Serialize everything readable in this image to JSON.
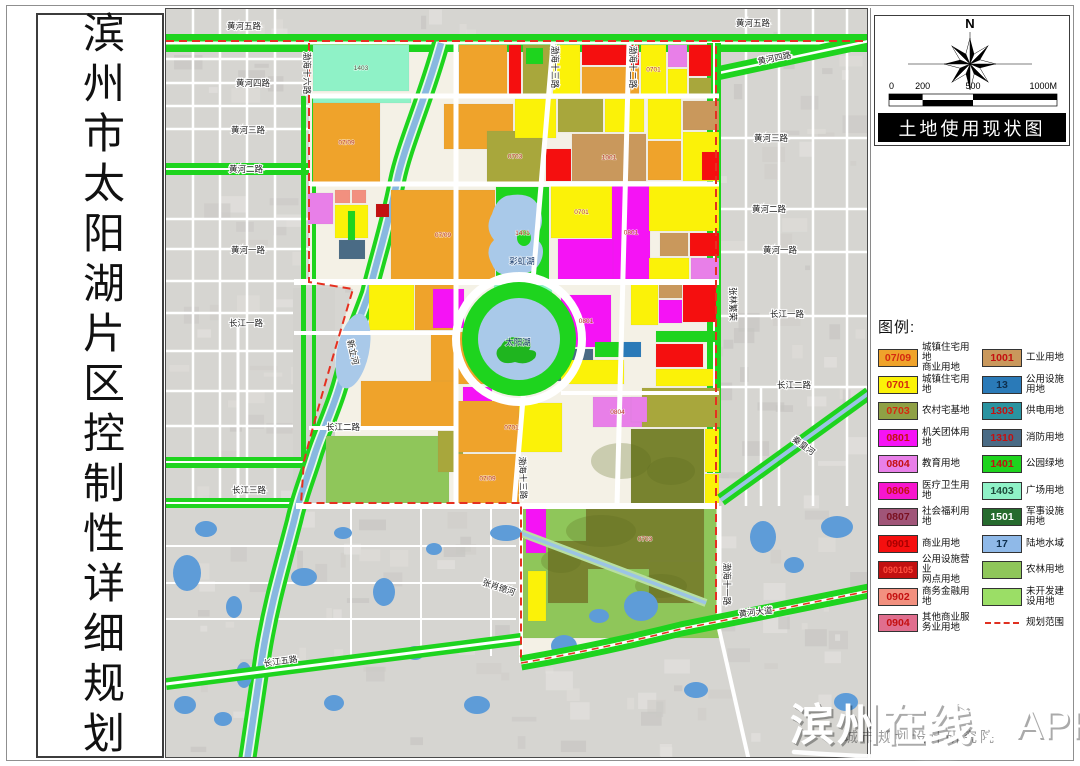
{
  "page_title": "滨州市太阳湖片区控制性详细规划",
  "map_title": "土地使用现状图",
  "compass": {
    "north_label": "N"
  },
  "scale": {
    "ticks": [
      "0",
      "200",
      "500",
      "1000M"
    ]
  },
  "legend": {
    "heading": "图例:",
    "left": [
      {
        "code": "07/09",
        "color": "#EFA32B",
        "code_color": "#D42A10",
        "label": "城镇住宅用地\n商业用地"
      },
      {
        "code": "0701",
        "color": "#FBF208",
        "code_color": "#D42A10",
        "label": "城镇住宅用地"
      },
      {
        "code": "0703",
        "color": "#8FA045",
        "code_color": "#D42A10",
        "label": "农村宅基地"
      },
      {
        "code": "0801",
        "color": "#F513F5",
        "code_color": "#C41010",
        "label": "机关团体用地"
      },
      {
        "code": "0804",
        "color": "#E87FE8",
        "code_color": "#C41010",
        "label": "教育用地"
      },
      {
        "code": "0806",
        "color": "#F716CE",
        "code_color": "#C41010",
        "label": "医疗卫生用地"
      },
      {
        "code": "0807",
        "color": "#A05578",
        "code_color": "#7A1020",
        "label": "社会福利用地"
      },
      {
        "code": "0901",
        "color": "#F50F0F",
        "code_color": "#A80000",
        "label": "商业用地"
      },
      {
        "code": "090105",
        "color": "#C21010",
        "code_color": "#FF5040",
        "label": "公用设施营业\n网点用地"
      },
      {
        "code": "0902",
        "color": "#F2907F",
        "code_color": "#C41010",
        "label": "商务金融用地"
      },
      {
        "code": "0904",
        "color": "#E06E8E",
        "code_color": "#C41010",
        "label": "其他商业服\n务业用地"
      }
    ],
    "right": [
      {
        "code": "1001",
        "color": "#C9985C",
        "code_color": "#C41010",
        "label": "工业用地"
      },
      {
        "code": "13",
        "color": "#2A7AB8",
        "code_color": "#0E2F4E",
        "label": "公用设施用地"
      },
      {
        "code": "1303",
        "color": "#2A93A0",
        "code_color": "#C41010",
        "label": "供电用地"
      },
      {
        "code": "1310",
        "color": "#4A6B85",
        "code_color": "#C41010",
        "label": "消防用地"
      },
      {
        "code": "1401",
        "color": "#1ED41E",
        "code_color": "#C41010",
        "label": "公园绿地"
      },
      {
        "code": "1403",
        "color": "#8FF2C7",
        "code_color": "#1E4A3A",
        "label": "广场用地"
      },
      {
        "code": "1501",
        "color": "#266B2E",
        "code_color": "#FFFFFF",
        "label": "军事设施用地"
      },
      {
        "code": "17",
        "color": "#8FB9E8",
        "code_color": "#0E2F4E",
        "label": "陆地水域"
      },
      {
        "code": "",
        "color": "#8FC65A",
        "code_color": "#000",
        "label": "农林用地"
      },
      {
        "code": "",
        "color": "#9BDE66",
        "code_color": "#000",
        "label": "未开发建设用地"
      },
      {
        "code": "",
        "color": "dash",
        "code_color": "#000",
        "label": "规划范围"
      }
    ]
  },
  "watermark": {
    "main": "滨州在线",
    "suffix": "APP",
    "behind": "城市规划设计研究院"
  },
  "map": {
    "palette": {
      "or": "#EFA32B",
      "ye": "#FBF208",
      "ol": "#A8A73C",
      "mg": "#F513F5",
      "vi": "#E87FE8",
      "pk": "#F716CE",
      "mv": "#A05578",
      "rd": "#F50F0F",
      "dr": "#C21010",
      "sa": "#F2907F",
      "ro": "#E06E8E",
      "tn": "#C9985C",
      "bl": "#2A7AB8",
      "te": "#2A93A0",
      "sl": "#4A6B85",
      "gr": "#1ED41E",
      "mi": "#8FF2C7",
      "dg": "#266B2E",
      "wa": "#8FB9E8",
      "fa": "#8FC65A",
      "un": "#9BDE66",
      "do": "#78832F",
      "gy": "#D3D2CE",
      "lk": "#A9C9E9",
      "pd": "#5E9CD8",
      "road": "#FFFFFF",
      "base": "#D6D5D1",
      "inner": "#F4F1E6",
      "boundary": "#E53020"
    },
    "parcels": [
      [
        312,
        44,
        96,
        46,
        "mi",
        "1403"
      ],
      [
        312,
        93,
        98,
        9,
        "mi"
      ],
      [
        458,
        44,
        48,
        49,
        "or"
      ],
      [
        508,
        44,
        12,
        49,
        "rd"
      ],
      [
        522,
        44,
        28,
        49,
        "ol"
      ],
      [
        525,
        47,
        17,
        16,
        "gr"
      ],
      [
        552,
        44,
        27,
        49,
        "ye"
      ],
      [
        581,
        44,
        57,
        20,
        "rd"
      ],
      [
        581,
        66,
        57,
        27,
        "or"
      ],
      [
        640,
        44,
        25,
        49,
        "ye",
        "0701"
      ],
      [
        667,
        44,
        19,
        22,
        "vi"
      ],
      [
        667,
        68,
        19,
        25,
        "ye"
      ],
      [
        688,
        44,
        22,
        31,
        "rd"
      ],
      [
        688,
        77,
        22,
        16,
        "ol"
      ],
      [
        312,
        102,
        67,
        79,
        "or",
        "07/09"
      ],
      [
        443,
        103,
        69,
        45,
        "or"
      ],
      [
        486,
        130,
        56,
        51,
        "ol",
        "0703"
      ],
      [
        514,
        98,
        41,
        39,
        "ye"
      ],
      [
        557,
        98,
        45,
        33,
        "ol"
      ],
      [
        604,
        98,
        39,
        33,
        "ye"
      ],
      [
        545,
        148,
        25,
        32,
        "rd"
      ],
      [
        571,
        133,
        74,
        47,
        "tn",
        "1001"
      ],
      [
        647,
        98,
        33,
        40,
        "ye"
      ],
      [
        647,
        140,
        33,
        39,
        "or"
      ],
      [
        682,
        100,
        36,
        29,
        "tn"
      ],
      [
        682,
        131,
        36,
        49,
        "ye"
      ],
      [
        701,
        151,
        17,
        28,
        "rd"
      ],
      [
        307,
        192,
        25,
        31,
        "vi"
      ],
      [
        334,
        189,
        15,
        13,
        "sa"
      ],
      [
        351,
        189,
        14,
        13,
        "sa"
      ],
      [
        334,
        204,
        33,
        33,
        "ye"
      ],
      [
        347,
        210,
        7,
        39,
        "gr"
      ],
      [
        338,
        239,
        26,
        19,
        "sl"
      ],
      [
        375,
        203,
        13,
        13,
        "dr"
      ],
      [
        390,
        189,
        104,
        90,
        "or",
        "07/09"
      ],
      [
        495,
        186,
        53,
        92,
        "gr",
        "1401"
      ],
      [
        550,
        185,
        61,
        52,
        "ye",
        "0701"
      ],
      [
        611,
        185,
        38,
        93,
        "mg",
        "0801"
      ],
      [
        557,
        238,
        55,
        40,
        "mg"
      ],
      [
        648,
        185,
        70,
        45,
        "ye"
      ],
      [
        659,
        232,
        28,
        23,
        "tn"
      ],
      [
        689,
        232,
        29,
        23,
        "rd"
      ],
      [
        648,
        257,
        40,
        21,
        "ye"
      ],
      [
        690,
        257,
        28,
        21,
        "vi"
      ],
      [
        368,
        284,
        45,
        45,
        "ye"
      ],
      [
        414,
        284,
        41,
        45,
        "or"
      ],
      [
        430,
        331,
        57,
        52,
        "or"
      ],
      [
        432,
        288,
        31,
        39,
        "mg"
      ],
      [
        493,
        283,
        58,
        11,
        "mi"
      ],
      [
        560,
        294,
        50,
        52,
        "mg",
        "0801"
      ],
      [
        630,
        283,
        27,
        41,
        "ye"
      ],
      [
        658,
        283,
        23,
        14,
        "tn"
      ],
      [
        682,
        283,
        33,
        38,
        "rd"
      ],
      [
        658,
        299,
        23,
        23,
        "mg"
      ],
      [
        553,
        348,
        39,
        32,
        "sl"
      ],
      [
        594,
        341,
        26,
        15,
        "gr"
      ],
      [
        621,
        341,
        19,
        15,
        "bl"
      ],
      [
        560,
        359,
        63,
        24,
        "ye"
      ],
      [
        462,
        386,
        29,
        15,
        "mg"
      ],
      [
        460,
        402,
        101,
        49,
        "ye",
        "0701"
      ],
      [
        592,
        396,
        49,
        30,
        "vi",
        "0804"
      ],
      [
        360,
        380,
        93,
        48,
        "or"
      ],
      [
        325,
        435,
        123,
        67,
        "fa"
      ],
      [
        437,
        430,
        25,
        41,
        "ol"
      ],
      [
        455,
        400,
        63,
        51,
        "or"
      ],
      [
        455,
        453,
        63,
        49,
        "or",
        "07/09"
      ],
      [
        655,
        330,
        63,
        11,
        "gr"
      ],
      [
        655,
        343,
        47,
        23,
        "rd"
      ],
      [
        655,
        368,
        57,
        17,
        "ye"
      ],
      [
        641,
        387,
        78,
        39,
        "ol"
      ],
      [
        630,
        396,
        16,
        25,
        "vi"
      ],
      [
        630,
        428,
        73,
        77,
        "do"
      ],
      [
        704,
        428,
        14,
        43,
        "ye"
      ],
      [
        704,
        473,
        14,
        32,
        "ye"
      ],
      [
        520,
        505,
        198,
        132,
        "fa"
      ],
      [
        585,
        508,
        118,
        60,
        "do",
        "0703"
      ],
      [
        547,
        540,
        40,
        62,
        "do"
      ],
      [
        648,
        560,
        55,
        42,
        "do"
      ],
      [
        525,
        508,
        20,
        44,
        "mg"
      ],
      [
        527,
        570,
        18,
        50,
        "ye"
      ]
    ],
    "ponds": [
      [
        205,
        528,
        11,
        8
      ],
      [
        186,
        572,
        14,
        18
      ],
      [
        233,
        606,
        8,
        11
      ],
      [
        303,
        576,
        13,
        9
      ],
      [
        342,
        532,
        9,
        6
      ],
      [
        383,
        591,
        11,
        14
      ],
      [
        433,
        548,
        8,
        6
      ],
      [
        476,
        704,
        13,
        9
      ],
      [
        505,
        532,
        16,
        8
      ],
      [
        762,
        536,
        13,
        16
      ],
      [
        793,
        564,
        10,
        8
      ],
      [
        836,
        526,
        16,
        11
      ],
      [
        414,
        652,
        9,
        7
      ],
      [
        333,
        702,
        10,
        8
      ],
      [
        243,
        674,
        8,
        13
      ],
      [
        184,
        704,
        11,
        9
      ],
      [
        695,
        689,
        12,
        8
      ],
      [
        845,
        701,
        12,
        9
      ],
      [
        222,
        718,
        9,
        7
      ],
      [
        640,
        605,
        17,
        15
      ],
      [
        598,
        615,
        10,
        7
      ],
      [
        563,
        645,
        13,
        11
      ]
    ],
    "road_labels": [
      [
        "黄河五路",
        243,
        28,
        0
      ],
      [
        "黄河五路",
        752,
        25,
        0
      ],
      [
        "黄河四路",
        252,
        85,
        0
      ],
      [
        "黄河四路",
        774,
        60,
        -12
      ],
      [
        "黄河三路",
        247,
        132,
        0
      ],
      [
        "黄河三路",
        770,
        140,
        0
      ],
      [
        "黄河二路",
        245,
        171,
        0
      ],
      [
        "黄河二路",
        768,
        211,
        0
      ],
      [
        "黄河一路",
        247,
        252,
        0
      ],
      [
        "黄河一路",
        779,
        252,
        0
      ],
      [
        "长江一路",
        245,
        325,
        0
      ],
      [
        "长江一路",
        786,
        316,
        0
      ],
      [
        "长江二路",
        342,
        429,
        0
      ],
      [
        "长江二路",
        793,
        387,
        0
      ],
      [
        "长江三路",
        248,
        492,
        0
      ],
      [
        "长江五路",
        280,
        663,
        -8
      ],
      [
        "黄河大道",
        755,
        614,
        -7
      ],
      [
        "渤海十六路",
        303,
        72,
        90
      ],
      [
        "渤海十三路",
        551,
        66,
        90
      ],
      [
        "渤海十三路",
        519,
        477,
        88
      ],
      [
        "渤海十二路",
        629,
        66,
        90
      ],
      [
        "渤海十一路",
        723,
        583,
        90
      ],
      [
        "张林繁荣",
        729,
        303,
        90
      ],
      [
        "秦皇河",
        801,
        447,
        36
      ],
      [
        "张肖德河",
        497,
        589,
        19
      ],
      [
        "新立河",
        349,
        352,
        77
      ]
    ],
    "water_labels": [
      [
        "彩虹湖",
        521,
        263
      ],
      [
        "太阳湖",
        517,
        344
      ]
    ]
  }
}
